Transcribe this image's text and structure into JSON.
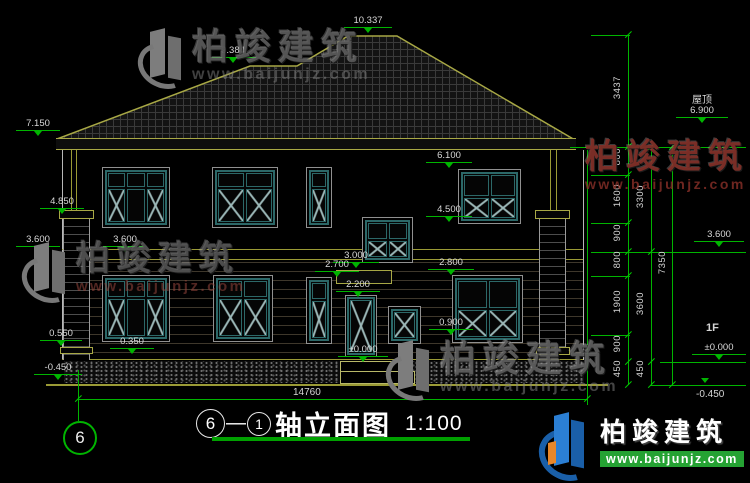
{
  "levels": {
    "ridge_main": "10.337",
    "ridge_left": "9.384",
    "eave_left": "7.150",
    "pilaster_cap": "4.850",
    "floor2_left_a": "3.600",
    "floor2_left_b": "3.600",
    "ledge_left": "0.550",
    "ground_left": "-0.450",
    "win2_head": "6.100",
    "win2_sill": "4.500",
    "stair_sill": "3.000",
    "canopy_top": "2.700",
    "door_head": "2.200",
    "win1_head": "2.800",
    "win1_sill": "0.900",
    "plinth_top": "0.350",
    "zero_center": "±0.000",
    "roof_right_label": "屋顶",
    "roof_right": "6.900",
    "floor2_right": "3.600",
    "floor1_label": "1F",
    "zero_right": "±0.000",
    "ground_right": "-0.450"
  },
  "dims": {
    "overall_width": "14760",
    "col1": [
      "3437",
      "800",
      "1600",
      "900",
      "800",
      "1900",
      "900",
      "450"
    ],
    "col2": [
      "3300",
      "3600",
      "450"
    ],
    "col3": [
      "7350"
    ]
  },
  "title": {
    "axis_start": "6",
    "separator": "—",
    "axis_end": "1",
    "name": "轴立面图",
    "scale": "1:100"
  },
  "axis_bubble": {
    "label": "6"
  },
  "watermark": {
    "brand": "柏竣建筑",
    "site": "www.baijunjz.com"
  },
  "logo": {
    "brand": "柏竣建筑",
    "site": "www.baijunjz.com"
  }
}
